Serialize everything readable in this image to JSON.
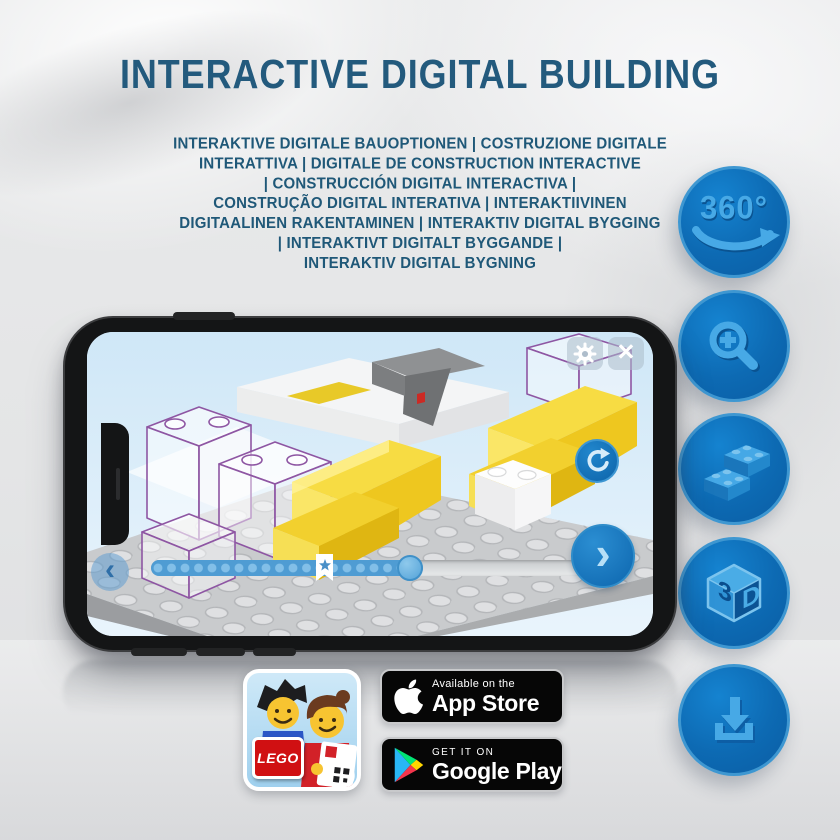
{
  "header": {
    "title": "INTERACTIVE DIGITAL BUILDING",
    "subtitle_lines": [
      "INTERAKTIVE DIGITALE BAUOPTIONEN | COSTRUZIONE DIGITALE",
      "INTERATTIVA | DIGITALE DE CONSTRUCTION INTERACTIVE",
      "| CONSTRUCCIÓN DIGITAL INTERACTIVA |",
      "CONSTRUÇÃO DIGITAL INTERATIVA | INTERAKTIIVINEN",
      "DIGITAALINEN RAKENTAMINEN | INTERAKTIV DIGITAL BYGGING",
      "| INTERAKTIVT DIGITALT BYGGANDE |",
      "INTERAKTIV DIGITAL BYGNING"
    ]
  },
  "features": {
    "rotate360": {
      "label": "360°",
      "icon": "360-rotation-arrow-icon"
    },
    "zoom": {
      "icon": "zoom-in-magnifier-icon"
    },
    "bricks": {
      "icon": "lego-bricks-icon"
    },
    "cube": {
      "icon": "3d-cube-icon",
      "face_left": "3",
      "face_right": "D"
    },
    "download": {
      "icon": "download-icon"
    }
  },
  "icons": {
    "close": "×",
    "chevron_left": "‹",
    "chevron_right": "›"
  },
  "store": {
    "app_icon_brand": "LEGO",
    "app_store": {
      "tagline": "Available on the",
      "name": "App Store"
    },
    "google_play": {
      "tagline": "GET IT ON",
      "name": "Google Play"
    }
  },
  "colors": {
    "title_blue": "#235A7D",
    "circle_blue": "#0D6AB3",
    "icon_light_blue": "#47A9E6",
    "screen_sky": "#D8EBF8",
    "lego_yellow": "#F2CF2A",
    "lego_red": "#D01012",
    "badge_black": "#060606"
  }
}
